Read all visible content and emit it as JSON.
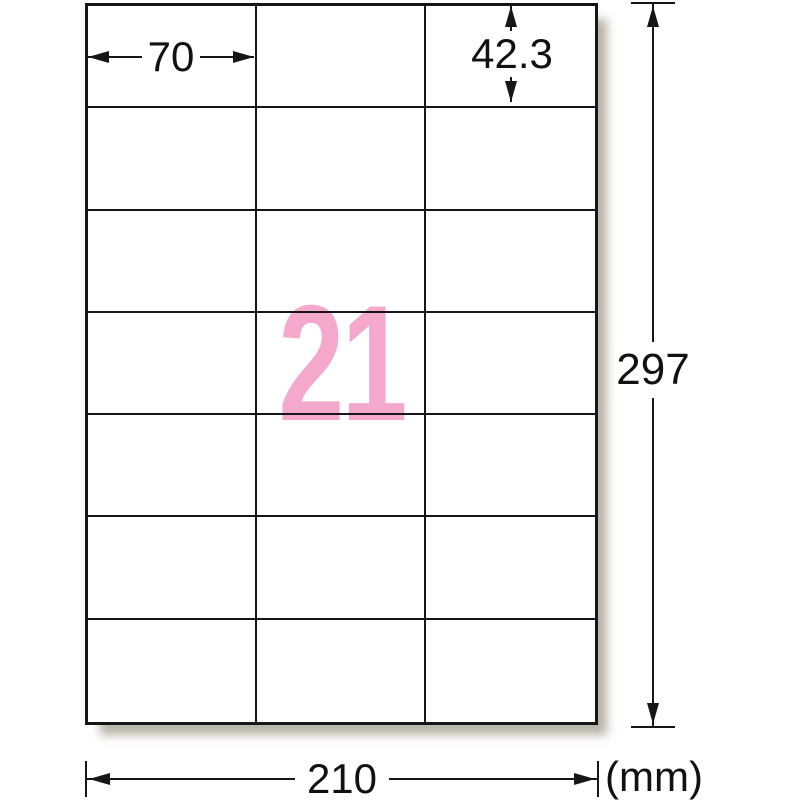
{
  "diagram": {
    "title": "label-sheet-dimension-diagram",
    "sheet": {
      "rows": 7,
      "columns": 3,
      "label_count": "21"
    },
    "dimensions": {
      "label_width": "70",
      "label_height": "42.3",
      "sheet_width": "210",
      "sheet_height": "297",
      "unit": "(mm)"
    },
    "colors": {
      "count_pink": "#f4a8cc",
      "line_black": "#161616",
      "shadow": "rgba(125,116,96,0.55)"
    }
  }
}
